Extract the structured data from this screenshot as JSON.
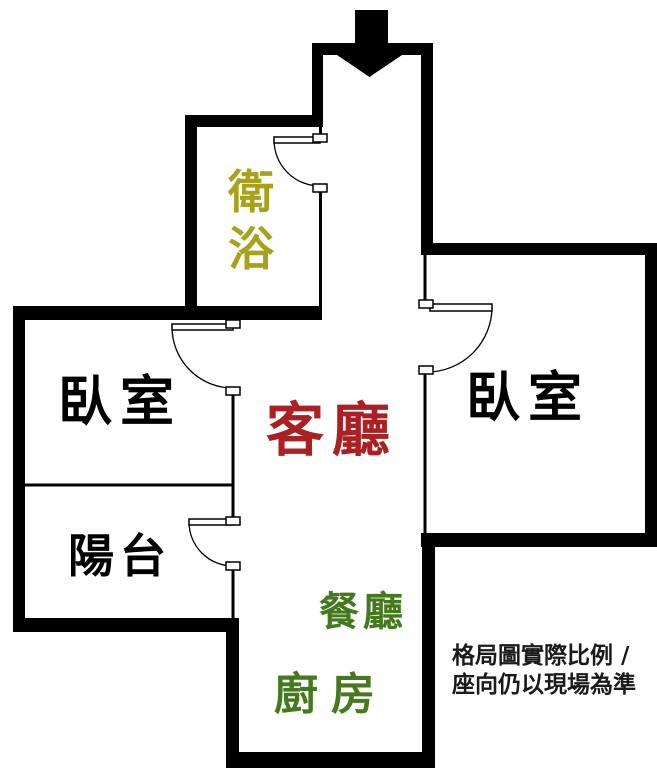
{
  "floorplan": {
    "entry": {
      "icon": "entry-arrow-down",
      "description_color": "#000000"
    },
    "rooms": {
      "bathroom": {
        "label": "衛浴",
        "color": "#a8a21b"
      },
      "bedroom_left": {
        "label": "臥室",
        "color": "#000000"
      },
      "living": {
        "label": "客廳",
        "color": "#ab2023"
      },
      "bedroom_right": {
        "label": "臥室",
        "color": "#000000"
      },
      "balcony": {
        "label": "陽台",
        "color": "#000000"
      },
      "dining": {
        "label": "餐廳",
        "color": "#45791e"
      },
      "kitchen": {
        "label": "廚房",
        "color": "#45791e"
      }
    },
    "disclaimer": {
      "line1": "格局圖實際比例 /",
      "line2": "座向仍以現場為準",
      "color": "#1a1a1a"
    },
    "wall_color": "#000000",
    "background_color": "#ffffff"
  }
}
